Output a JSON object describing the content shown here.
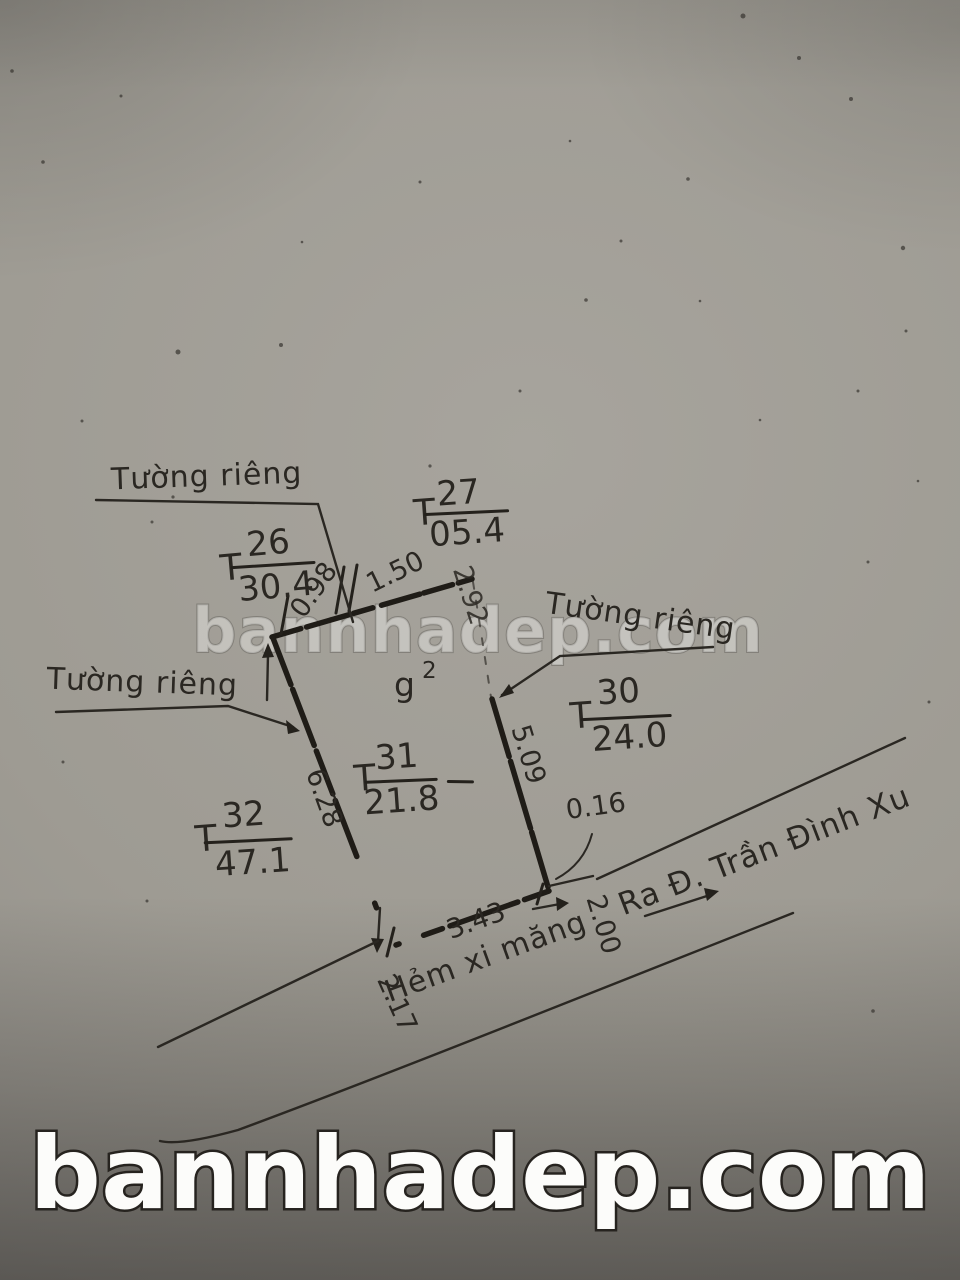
{
  "watermark": {
    "center_text": "bannhadep.com",
    "bottom_text": "bannhadep.com",
    "color": "#fcfcfa"
  },
  "diagram": {
    "wall_labels": [
      {
        "id": "top-left",
        "text": "Tường riêng"
      },
      {
        "id": "right",
        "text": "Tường riêng"
      },
      {
        "id": "left",
        "text": "Tường riêng"
      }
    ],
    "parcels": [
      {
        "id": "T26",
        "prefix": "T",
        "number": "26",
        "area": "30.4"
      },
      {
        "id": "T27",
        "prefix": "T",
        "number": "27",
        "area": "05.4"
      },
      {
        "id": "T30",
        "prefix": "T",
        "number": "30",
        "area": "24.0"
      },
      {
        "id": "T31",
        "prefix": "T",
        "number": "31",
        "area": "21.8"
      },
      {
        "id": "T32",
        "prefix": "T",
        "number": "32",
        "area": "47.1"
      }
    ],
    "structure_note": {
      "main": "g",
      "sup": "2"
    },
    "dimensions": [
      {
        "id": "top-left-segment",
        "value": "0.98"
      },
      {
        "id": "top-mid-segment",
        "value": "1.50"
      },
      {
        "id": "top-right-segment",
        "value": "2.92"
      },
      {
        "id": "left-edge",
        "value": "6.28"
      },
      {
        "id": "right-edge",
        "value": "5.09"
      },
      {
        "id": "corner-offset",
        "value": "0.16"
      },
      {
        "id": "bottom-edge",
        "value": "3.43"
      },
      {
        "id": "alley-width",
        "value": "2.00"
      },
      {
        "id": "alley-left",
        "value": "2.17"
      }
    ],
    "street_note": "Ra Đ. Trần Đình Xu",
    "alley_label": "Hẻm xi măng",
    "ink_color": "#2a2722"
  }
}
